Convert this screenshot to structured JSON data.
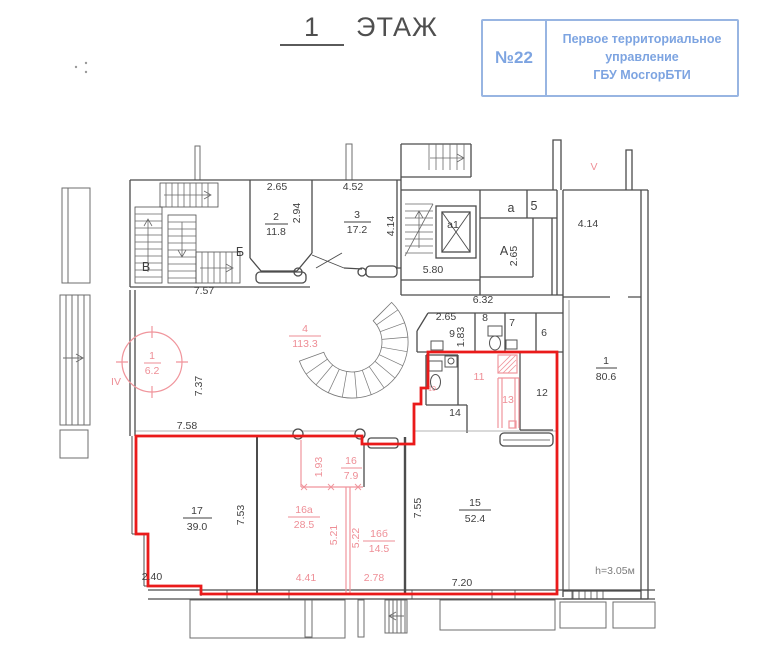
{
  "title": {
    "number": "1",
    "word": "ЭТАЖ"
  },
  "stamp": {
    "number": "№22",
    "line1": "Первое территориальное",
    "line2": "управление",
    "line3": "ГБУ МосгорБТИ"
  },
  "plan": {
    "colors": {
      "selection_red": "#ea1a1a",
      "annotation_pink": "#ee8e96",
      "stamp_blue": "#6c98dd",
      "ink": "#3f3f3f"
    },
    "labels": {
      "d265_r2": "2.65",
      "r2_num": "2",
      "r2_area": "11.8",
      "d294": "2.94",
      "d452": "4.52",
      "r3_num": "3",
      "r3_area": "17.2",
      "d414_r3": "4.14",
      "st_B": "Б",
      "st_V": "В",
      "d757": "7.57",
      "lift_a1": "а1",
      "rm_a": "а",
      "rm_5": "5",
      "st_A": "А",
      "d265_A": "2.65",
      "d580": "5.80",
      "d414_V": "4.14",
      "sec_V": "V",
      "sec_IV": "IV",
      "d632": "6.32",
      "d265_9": "2.65",
      "r9": "9",
      "d183": "1.83",
      "r8": "8",
      "r7": "7",
      "r6": "6",
      "r1r_num": "1",
      "r1r_area": "80.6",
      "r1c_num": "1",
      "r1c_area": "6.2",
      "r4_num": "4",
      "r4_area": "113.3",
      "d737": "7.37",
      "d758": "7.58",
      "r10": "10",
      "r11": "11",
      "r12": "12",
      "r13": "13",
      "r14": "14",
      "d193": "1.93",
      "r16_num": "16",
      "r16_area": "7.9",
      "r16a_num": "16а",
      "r16a_area": "28.5",
      "d521": "5.21",
      "d522": "5.22",
      "r16b_num": "16б",
      "r16b_area": "14.5",
      "d441": "4.41",
      "d278": "2.78",
      "r17_num": "17",
      "r17_area": "39.0",
      "d753": "7.53",
      "d240": "2.40",
      "r15_num": "15",
      "r15_area": "52.4",
      "d755": "7.55",
      "d720": "7.20",
      "h_note": "h=3.05м"
    }
  }
}
